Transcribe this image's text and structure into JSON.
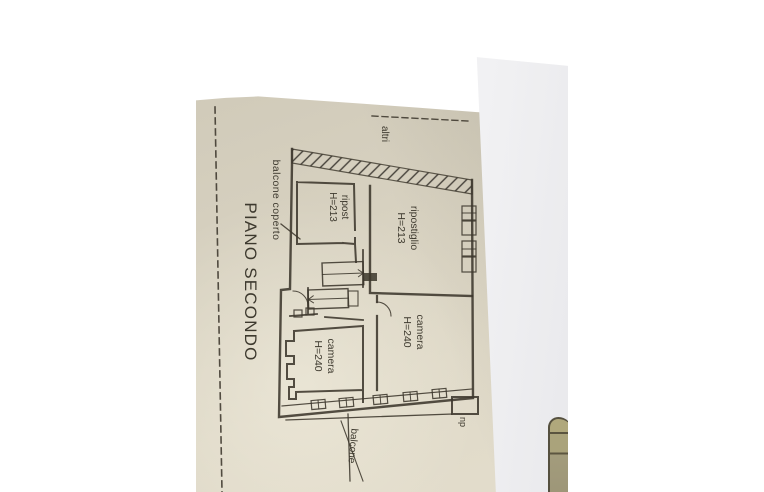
{
  "plan": {
    "title": "PIANO SECONDO",
    "labels": {
      "balcone_coperto": "balcone coperto",
      "altri": "altri",
      "ripost": {
        "l1": "ripost",
        "l2": "H=213"
      },
      "ripostiglio": {
        "l1": "ripostiglio",
        "l2": "H=213"
      },
      "camera_right": {
        "l1": "camera",
        "l2": "H=240"
      },
      "camera_left": {
        "l1": "camera",
        "l2": "H=240"
      },
      "np": "np",
      "balcone": "balcone"
    }
  },
  "colors": {
    "wood_dark": "#2a160b",
    "wood_mid": "#5c2f18",
    "wood_light": "#c48d3d",
    "paper_cream": "#d9d3c2",
    "paper_white": "#efeff1",
    "ink": "#3c372c",
    "fragment_tan": "#a49c7e"
  }
}
